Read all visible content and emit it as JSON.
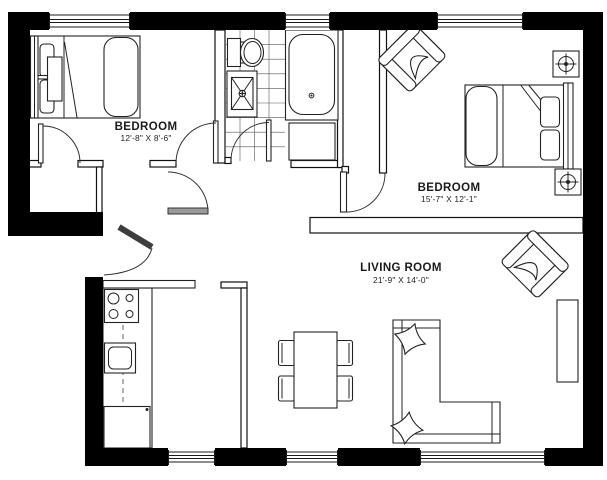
{
  "plan": {
    "type": "apartment-floor-plan",
    "rooms": [
      {
        "name": "BEDROOM",
        "dims": "12'-8\" X 8'-6\""
      },
      {
        "name": "BEDROOM",
        "dims": "15'-7\" X 12'-1\""
      },
      {
        "name": "LIVING ROOM",
        "dims": "21'-9\" X 14'-0\""
      }
    ],
    "fixtures": [
      "double-bed",
      "double-bed",
      "bathtub",
      "toilet",
      "shower-sink",
      "tile-floor",
      "kitchen-counter",
      "stove-cooktop",
      "kitchen-sink",
      "refrigerator",
      "dining-table",
      "dining-chair",
      "dining-chair",
      "dining-chair",
      "dining-chair",
      "sectional-sofa",
      "throw-pillow",
      "throw-pillow",
      "armchair",
      "armchair",
      "tv-console",
      "speaker",
      "speaker",
      "closet",
      "entry-door"
    ],
    "counts": {
      "windows_top": 3,
      "windows_bottom": 3,
      "door_swings": 6
    },
    "colors": {
      "walls": "#000000",
      "lines": "#222222",
      "door_leaf": "#555555",
      "floor": "#ffffff"
    }
  }
}
